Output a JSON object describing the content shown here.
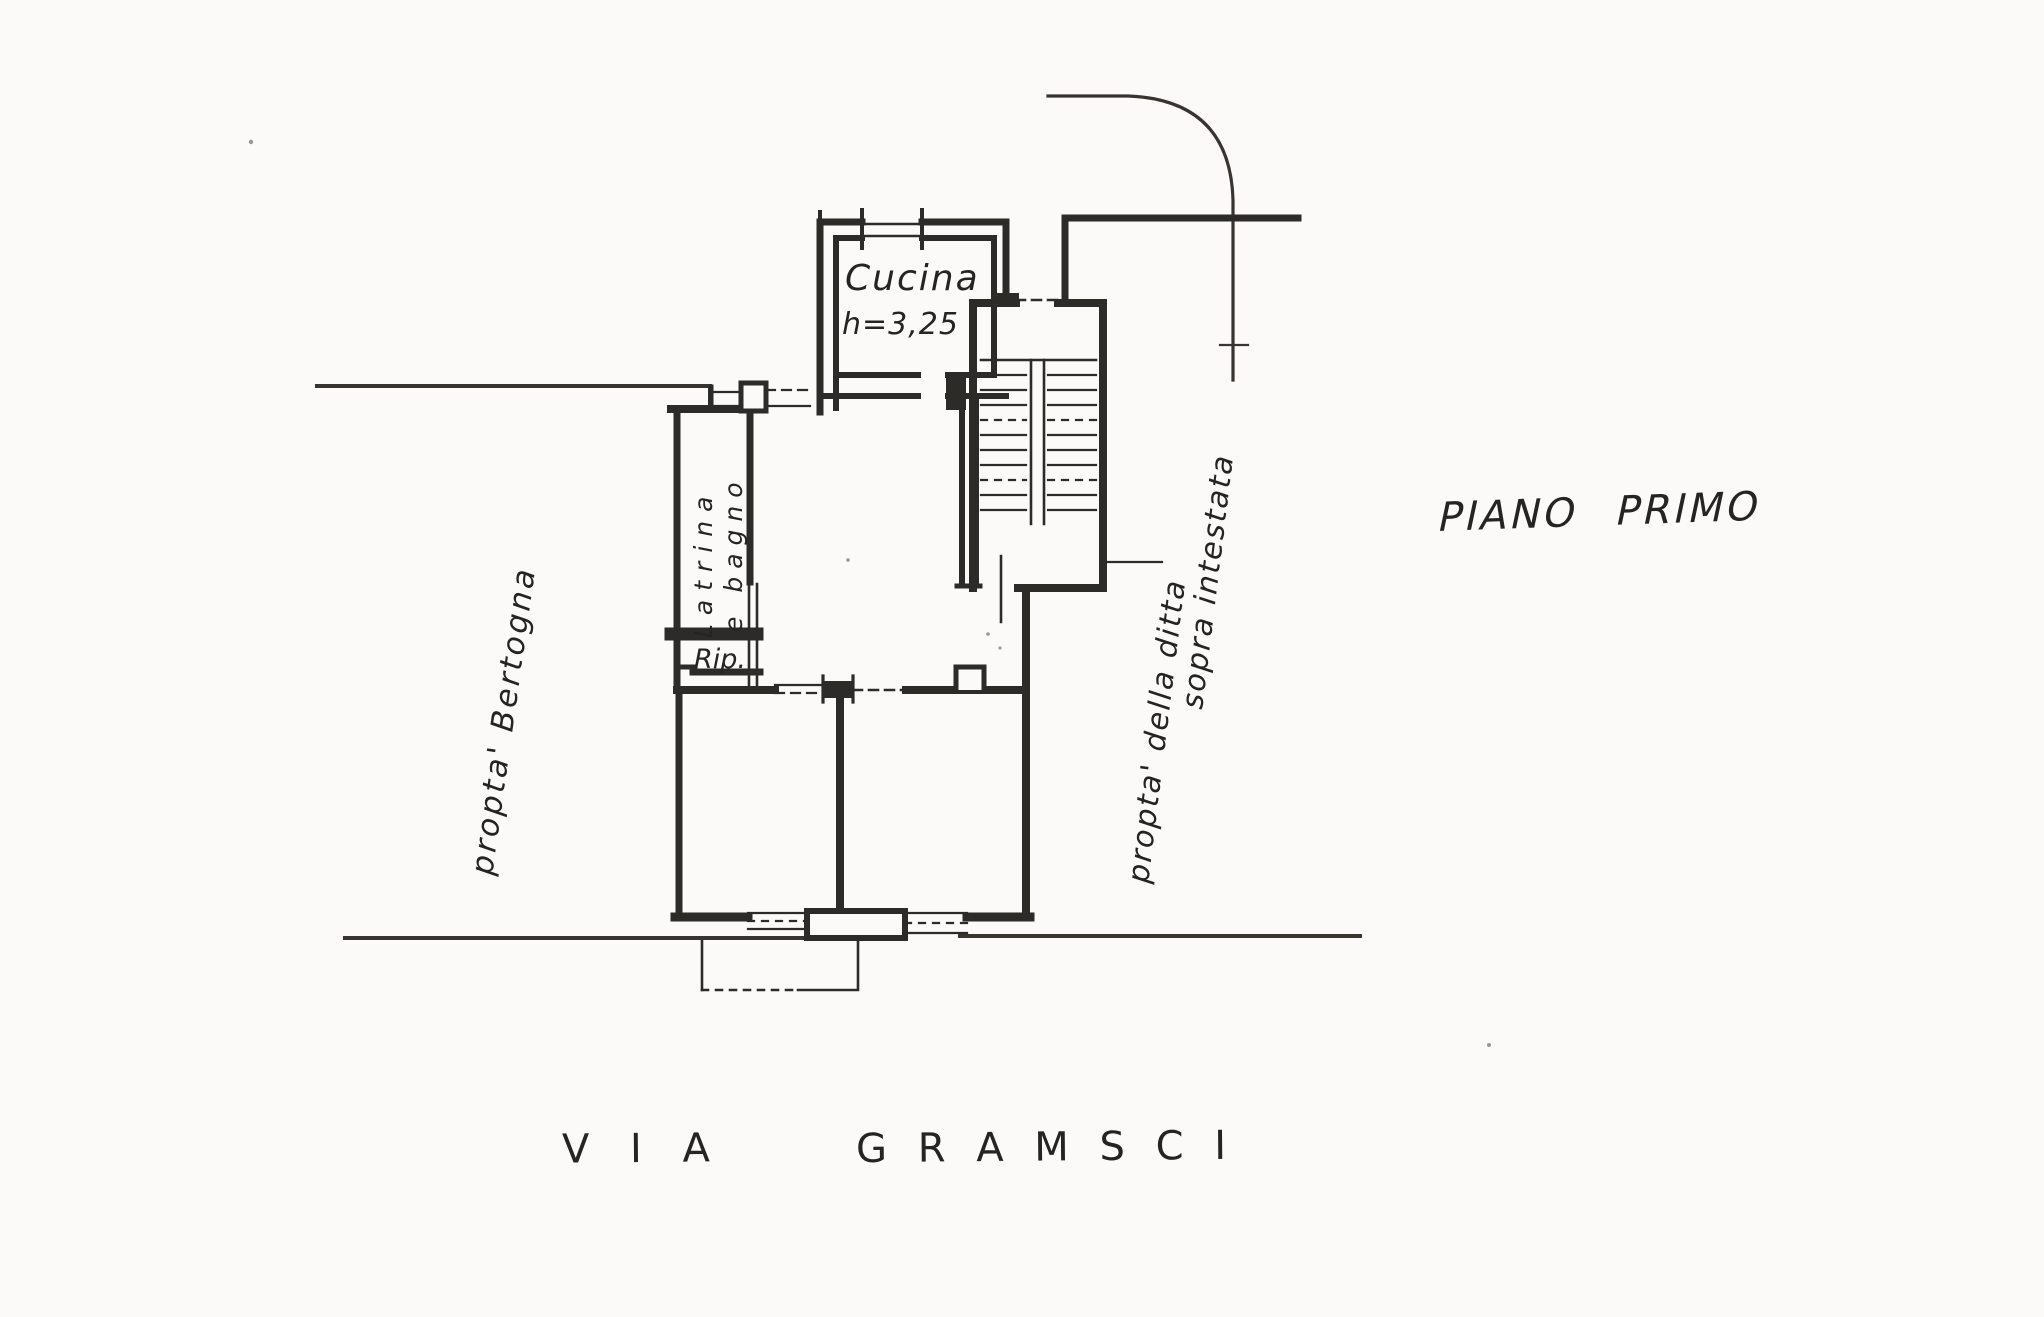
{
  "colors": {
    "paper": "#fbfaf8",
    "ink": "#2d2b28",
    "site_line": "#38342f"
  },
  "title": {
    "word1": "PIANO",
    "word2": "PRIMO"
  },
  "street": {
    "via": "V I A",
    "name": "G R A M S C I"
  },
  "rooms": {
    "kitchen": {
      "name": "Cucina",
      "height": "h=3,25"
    },
    "bath": {
      "line1": "Latrina",
      "line2": "e bagno"
    },
    "storage": {
      "name": "Rip."
    }
  },
  "properties": {
    "left": "propta'  Bertogna",
    "right_line1": "propta' della ditta",
    "right_line2": "sopra intestata"
  }
}
